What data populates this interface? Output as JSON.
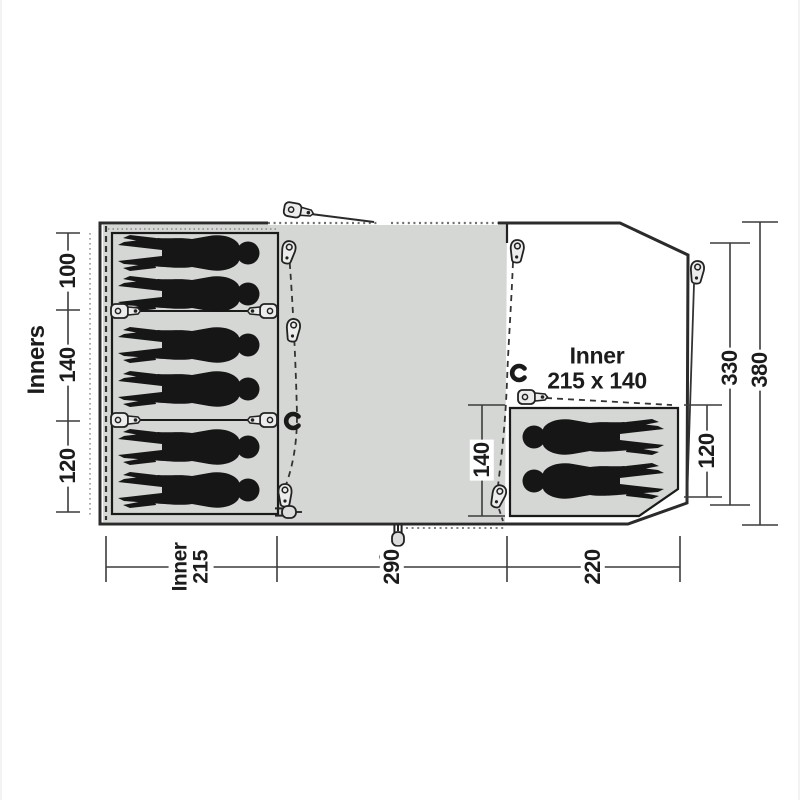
{
  "diagram": {
    "type": "tent-floorplan",
    "colors": {
      "background": "#ffffff",
      "area_fill": "#d5d7d4",
      "outline": "#2b2b2b",
      "figure": "#161616",
      "dimension_line": "#3c3c3c",
      "text": "#1c1c1c"
    },
    "left_axis": {
      "label": "Inners",
      "segments": [
        "100",
        "140",
        "120"
      ]
    },
    "bottom_axis": {
      "segments": [
        {
          "lines": [
            "Inner",
            "215"
          ]
        },
        {
          "lines": [
            "290"
          ]
        },
        {
          "lines": [
            "220"
          ]
        }
      ]
    },
    "right_axis": {
      "segments": [
        "120",
        "330",
        "380"
      ]
    },
    "porch": {
      "inner_width": "140",
      "label_line1": "Inner",
      "label_line2": "215 x 140"
    },
    "figures": {
      "left_sleepers": 6,
      "porch_sleepers": 2
    }
  }
}
